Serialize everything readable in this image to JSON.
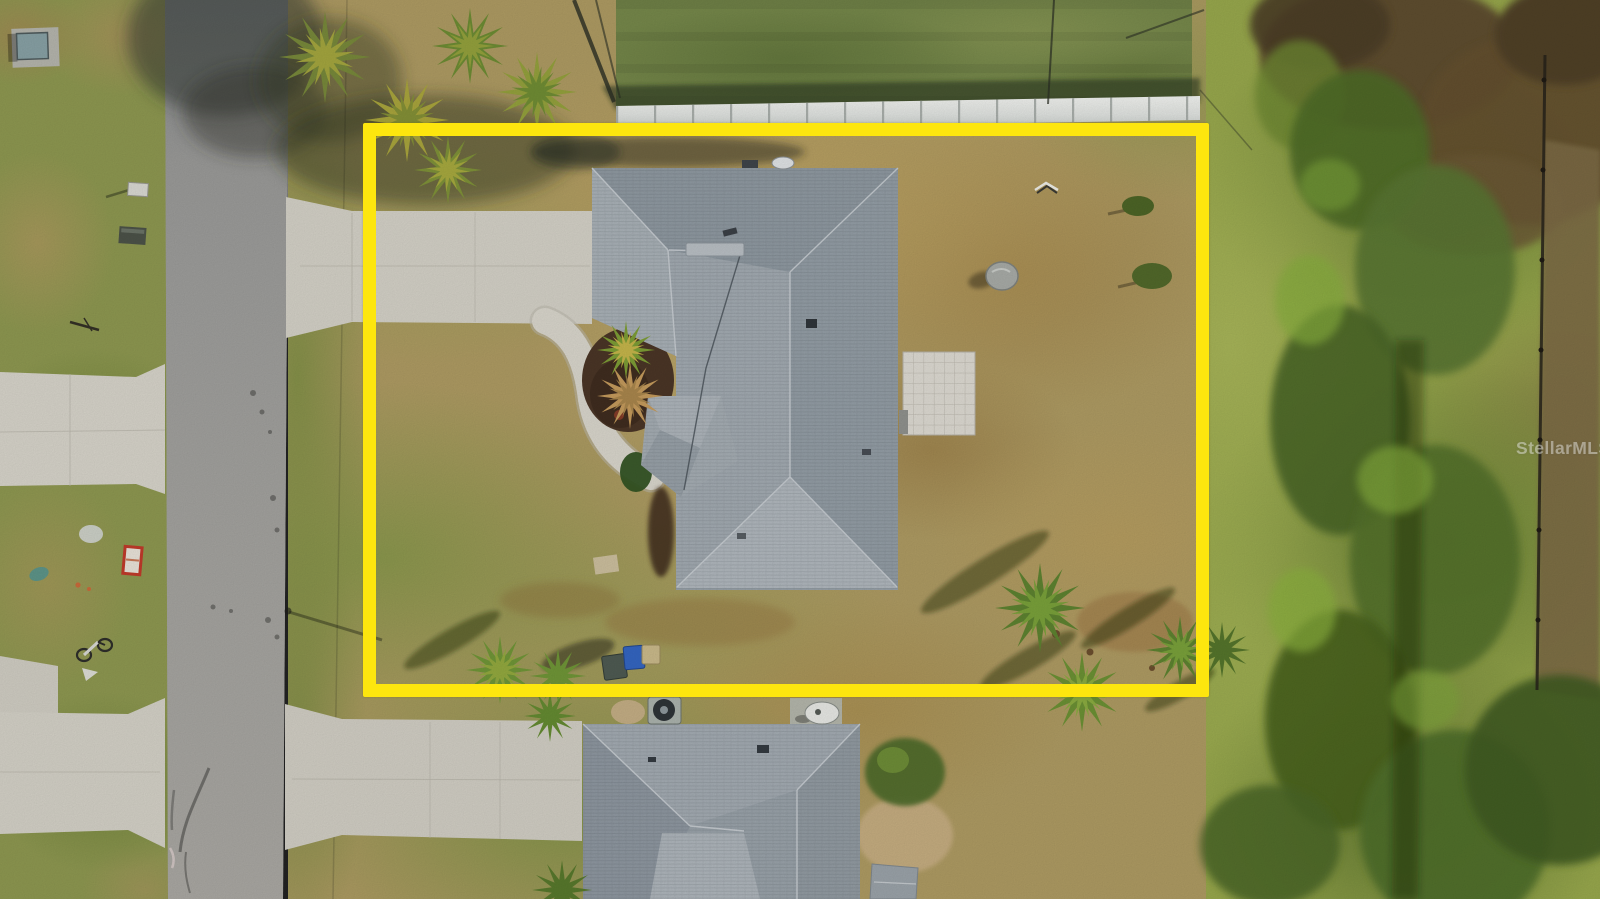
{
  "watermark": {
    "text": "StellarMLS"
  },
  "theme": {
    "boundary-yellow": "#fde60e",
    "roof-gray": "#9aa3aa",
    "road-gray": "#9c9c9a",
    "concrete-gray": "#d3d0c6",
    "grass-green": "#8d9750",
    "dry-grass-tan": "#b09a62",
    "vegetation-dark-green": "#50702c",
    "mulch-brown": "#4a3526",
    "white-fence": "#edeeec",
    "blue-bin": "#3465c0"
  }
}
